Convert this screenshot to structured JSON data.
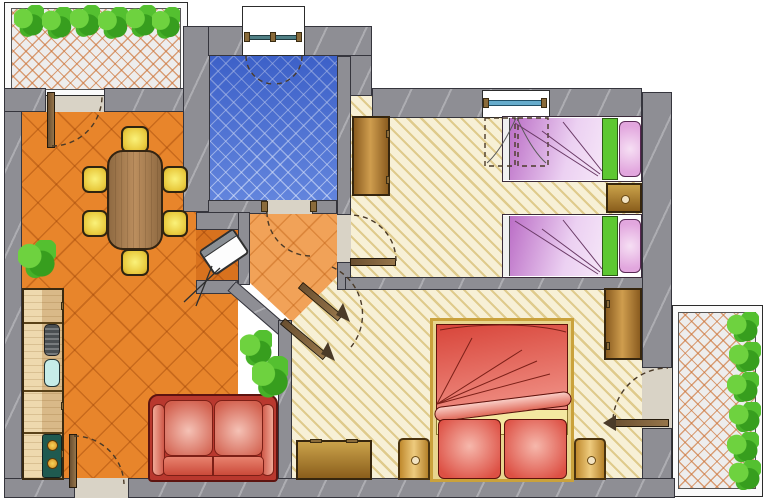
{
  "floor_plan": {
    "kind": "apartment floor plan, top-down architectural drawing, no text labels",
    "rooms": [
      {
        "key": "balcony_top",
        "label": "Top balcony with planter boxes"
      },
      {
        "key": "living_dining",
        "label": "Living / dining room with kitchen"
      },
      {
        "key": "bathroom",
        "label": "Bathroom"
      },
      {
        "key": "hallway",
        "label": "Hallway"
      },
      {
        "key": "bedroom_twin",
        "label": "Twin bedroom"
      },
      {
        "key": "bedroom_double",
        "label": "Double bedroom"
      },
      {
        "key": "balcony_bottom",
        "label": "Bottom-right balcony with planter boxes"
      }
    ],
    "furniture": {
      "living_dining": [
        "kitchen counter",
        "kitchen sink",
        "stove with two burners",
        "dining table",
        "six yellow chairs",
        "tv in corner niche",
        "red two-seat sofa",
        "plant"
      ],
      "bathroom": [
        "washbasin",
        "toilet",
        "bidet",
        "shower cabin",
        "casement window"
      ],
      "bedroom_twin": [
        "wardrobe",
        "single bed",
        "single bed",
        "nightstand",
        "casement window"
      ],
      "bedroom_double": [
        "double bed",
        "nightstand left",
        "nightstand right",
        "dresser",
        "wardrobe",
        "door to balcony"
      ]
    },
    "palette": {
      "wall": "#8e8e94",
      "living_floor": "#e8852b",
      "hall_floor": "#f1a258",
      "bath_floor": "#4d74d8",
      "bedroom_floor": "#f7f0d6",
      "balcony_tile": "#ededed",
      "sofa_red": "#c84a3e",
      "double_bed_red": "#e0493a",
      "twin_bed_purple": "#d9a0e0",
      "blanket_green": "#5dc832",
      "chair_yellow": "#f0d84a",
      "wood": "#b5812a",
      "plant_green": "#4db32c"
    }
  }
}
